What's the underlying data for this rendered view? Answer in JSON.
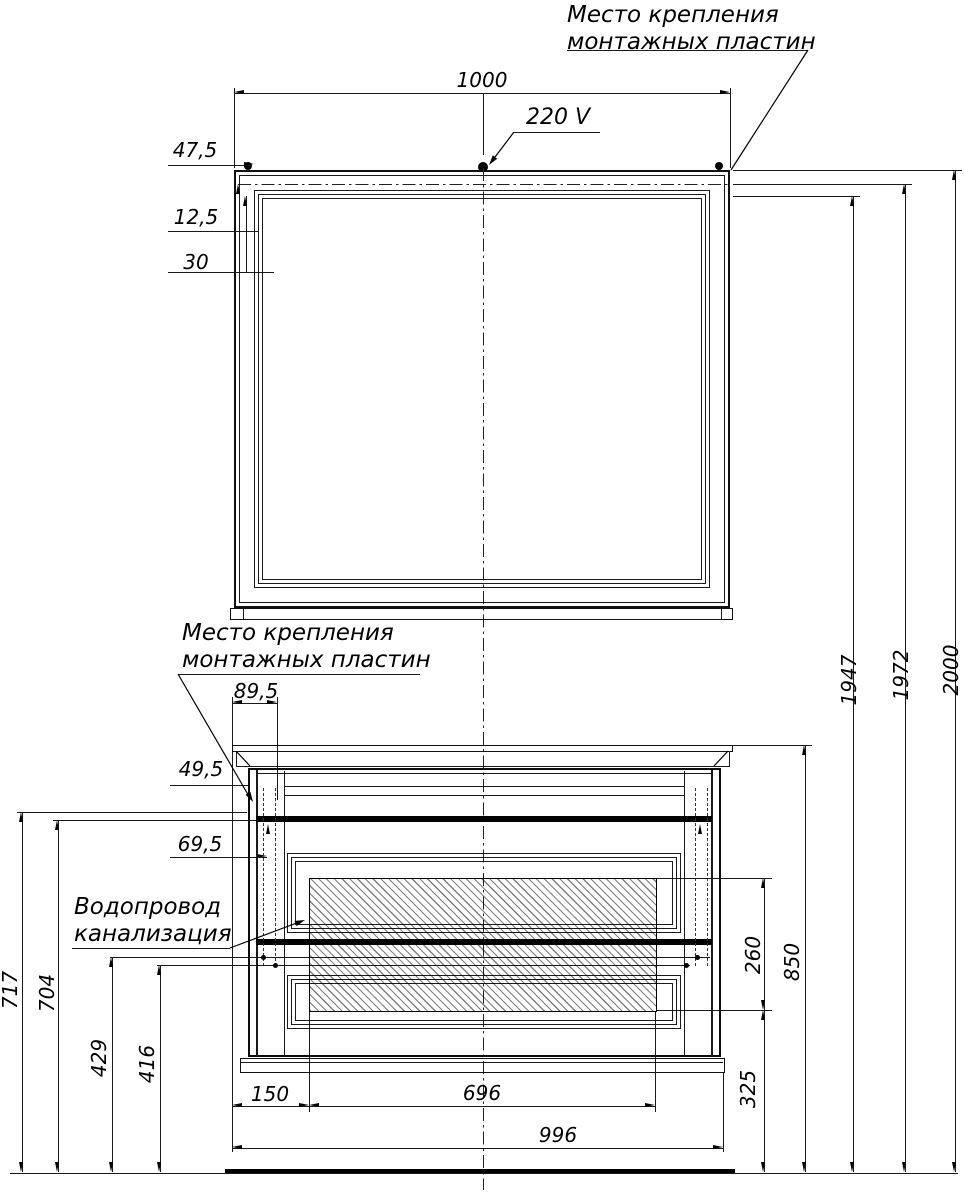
{
  "drawing": {
    "labels": {
      "mirror_mount": {
        "line1": "Место крепления",
        "line2": "монтажных пластин"
      },
      "cabinet_mount": {
        "line1": "Место крепления",
        "line2": "монтажных пластин"
      },
      "power": "220 V",
      "plumbing": {
        "line1": "Водопровод",
        "line2": "канализация"
      }
    },
    "dimensions": {
      "mirror_width": "1000",
      "mount_offset_x": "47,5",
      "mount_offset_y1": "12,5",
      "mount_offset_y2": "30",
      "cab_mount_far": "89,5",
      "cab_mount_side": "49,5",
      "cab_mount_near": "69,5",
      "h_717": "717",
      "h_704": "704",
      "h_429": "429",
      "h_416": "416",
      "water_zone_h": "260",
      "water_zone_bottom": "325",
      "counter_h": "850",
      "h_1947": "1947",
      "h_1972": "1972",
      "h_total": "2000",
      "zone_left": "150",
      "zone_width": "696",
      "cab_width": "996"
    }
  }
}
